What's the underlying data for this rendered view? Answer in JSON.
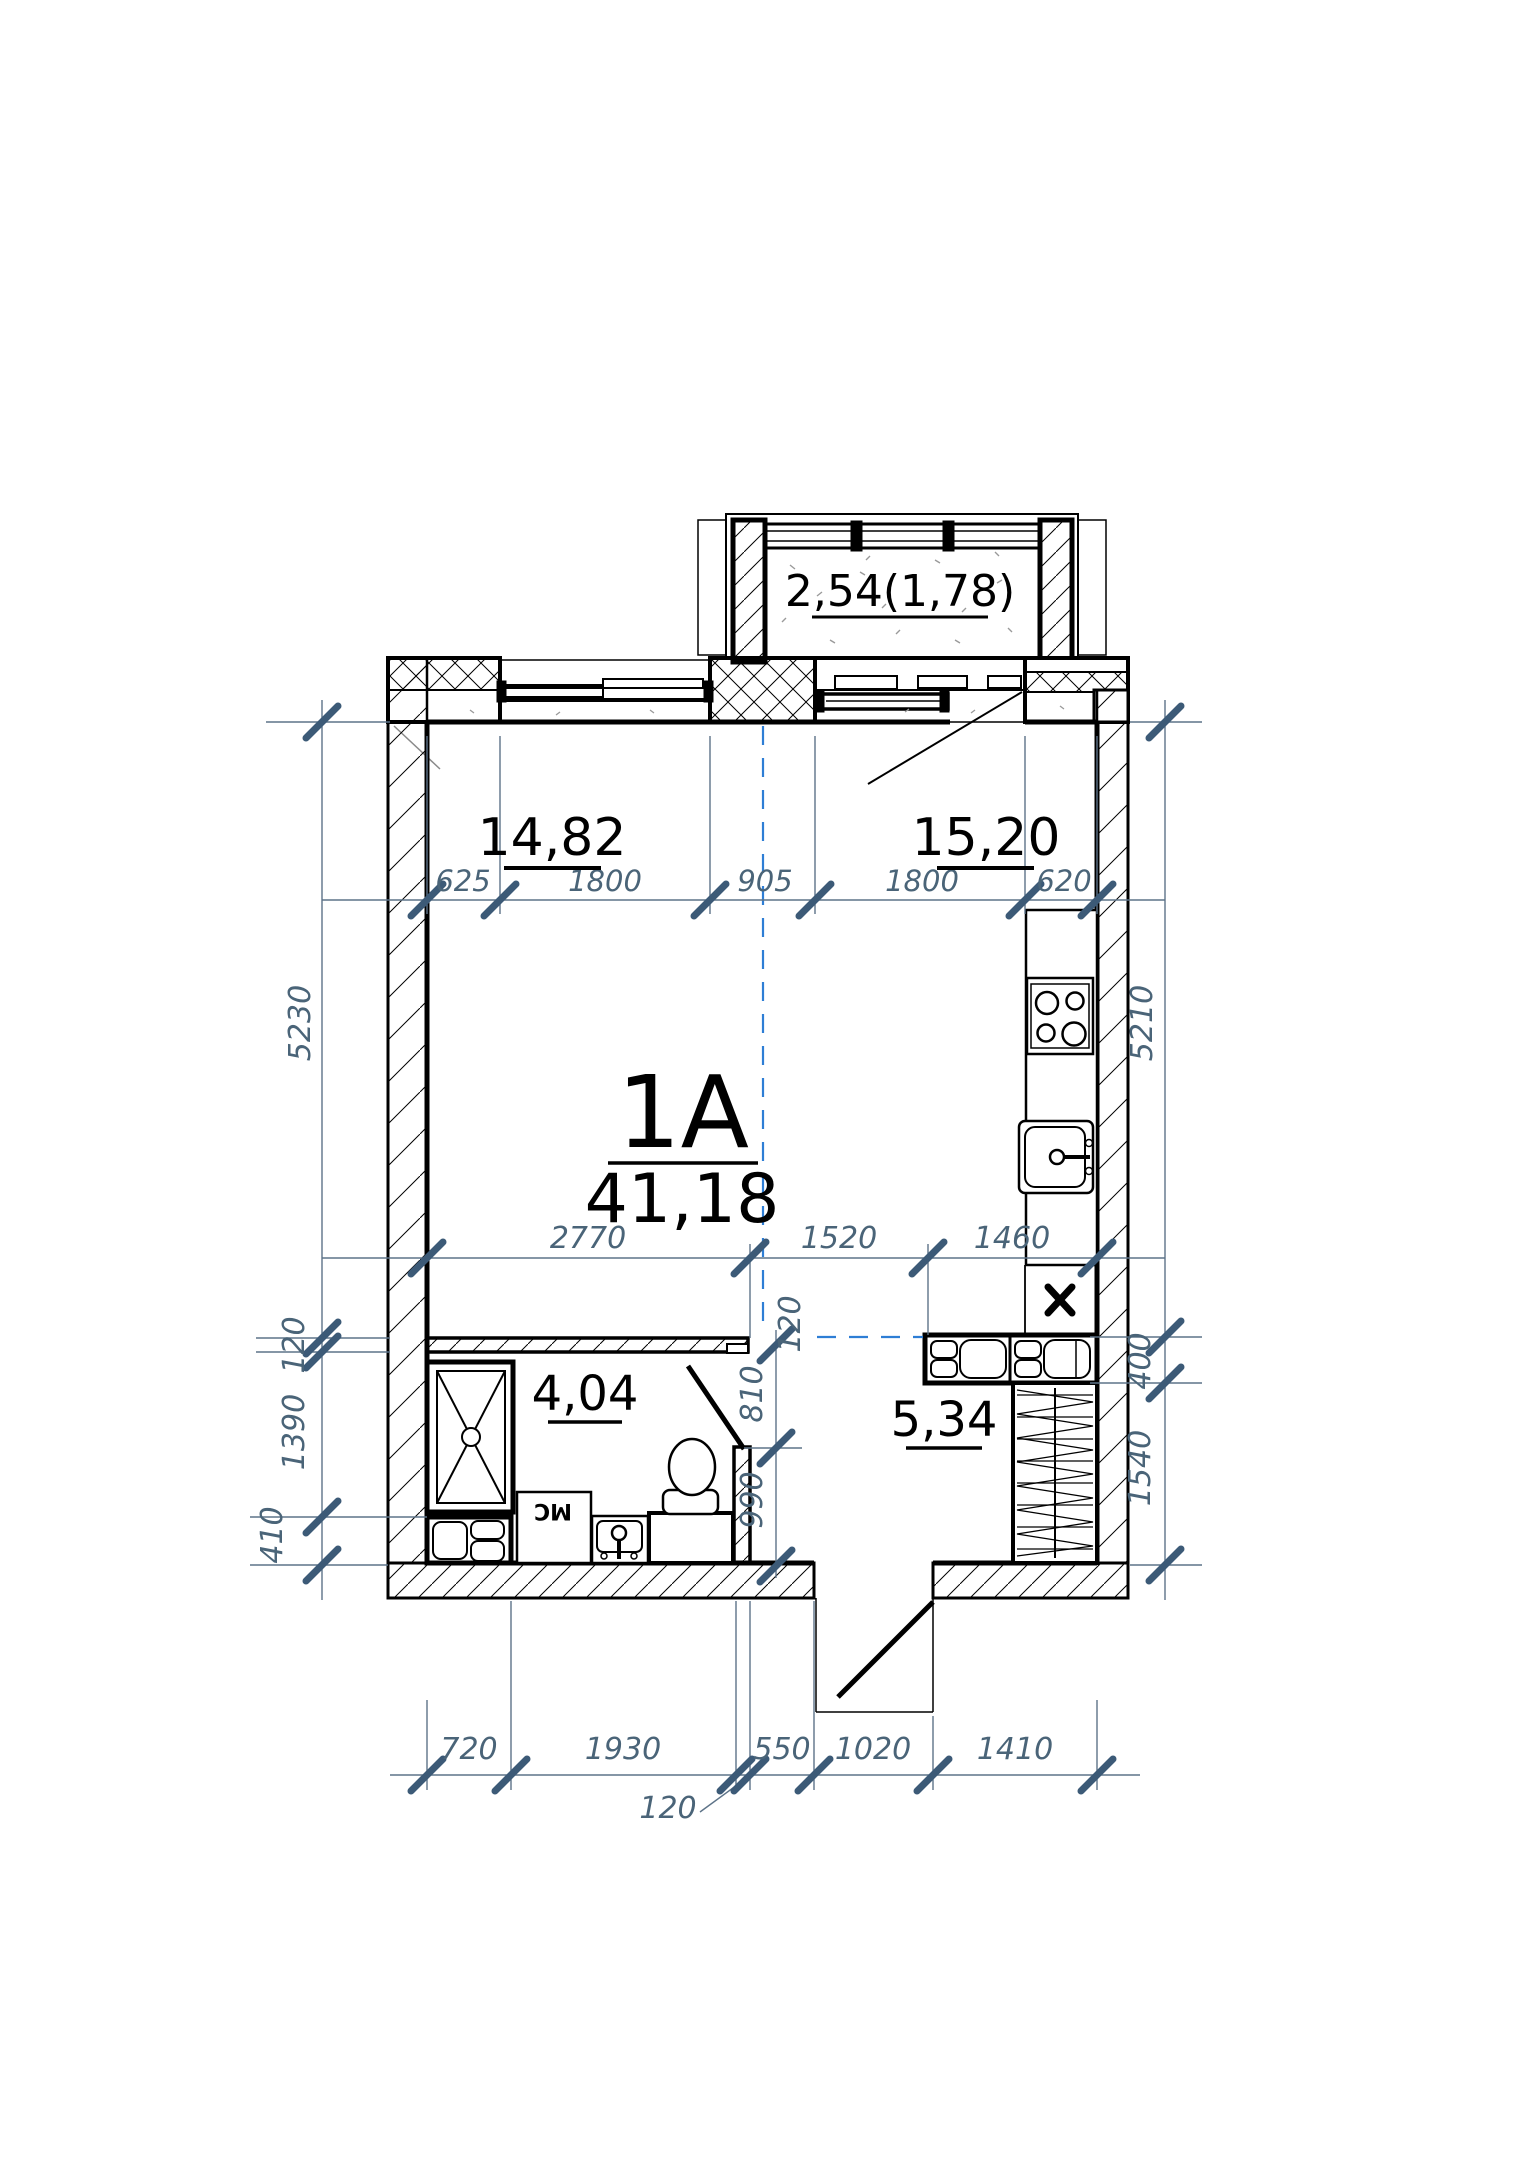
{
  "drawing": {
    "type": "apartment-floor-plan"
  },
  "unit": {
    "id": "1A",
    "total_area": "41,18"
  },
  "rooms": {
    "living_area": "14,82",
    "kitchen_area": "15,20",
    "bathroom_area": "4,04",
    "hallway_area": "5,34",
    "balcony_area": "2,54(1,78)"
  },
  "equipment": {
    "washing_machine": "МС"
  },
  "dims": {
    "top": [
      "625",
      "1800",
      "905",
      "1800",
      "620"
    ],
    "middle": [
      "2770",
      "1520",
      "1460"
    ],
    "bottom": [
      "720",
      "1930",
      "550",
      "1020",
      "1410"
    ],
    "bottom_callout": "120",
    "left": {
      "room_height": "5230",
      "wall": "120",
      "bath": "1390",
      "lower": "410"
    },
    "right": {
      "room_height": "5210",
      "upper": "400",
      "lower": "1540"
    },
    "bath": {
      "wall": "120",
      "upper": "810",
      "lower": "990"
    }
  },
  "colors": {
    "ink": "#000000",
    "paper": "#ffffff",
    "dim_text": "#4a6478",
    "dim_line": "#5d7388",
    "tick": "#3c5a77",
    "axis_blue": "#2e7ed5"
  }
}
